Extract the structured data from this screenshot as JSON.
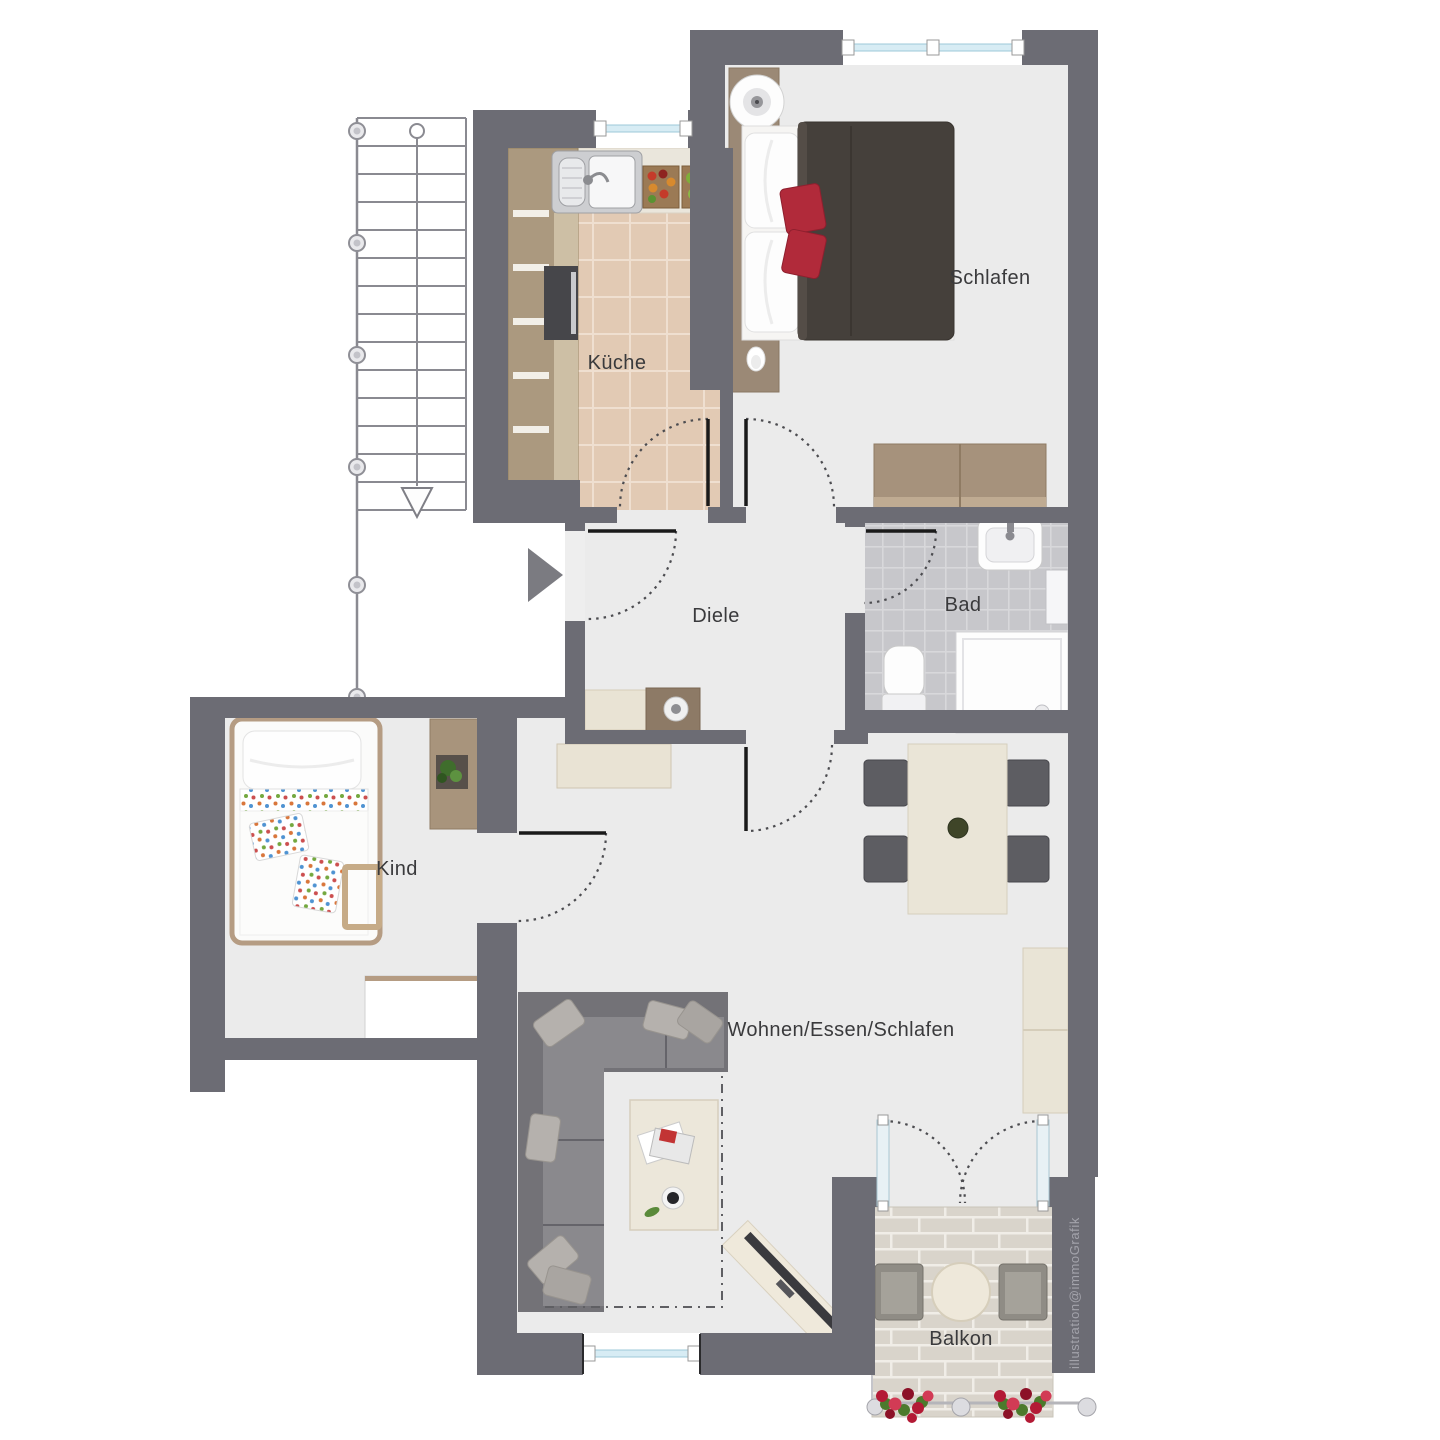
{
  "watermark": "illustration@immoGrafik",
  "rooms": {
    "kueche": {
      "label": "Küche"
    },
    "schlafen": {
      "label": "Schlafen"
    },
    "bad": {
      "label": "Bad"
    },
    "diele": {
      "label": "Diele"
    },
    "kind": {
      "label": "Kind"
    },
    "wohnen": {
      "label": "Wohnen/Essen/Schlafen"
    },
    "balkon": {
      "label": "Balkon"
    }
  },
  "palette": {
    "wall": "#6c6c74",
    "room_floor": "#ebebeb",
    "kitchen_tile": "#e2cab4",
    "bath_tile": "#c7c7cb",
    "balcony_brick": "#d9d4cb",
    "wood_dark": "#a8967e",
    "wood_light": "#e9e3d4",
    "sofa_gray": "#737277",
    "duvet_brown": "#45403b",
    "accent_red": "#b12a3a",
    "window_blue": "#d7ecf4",
    "label_text": "#3a3a3c"
  }
}
